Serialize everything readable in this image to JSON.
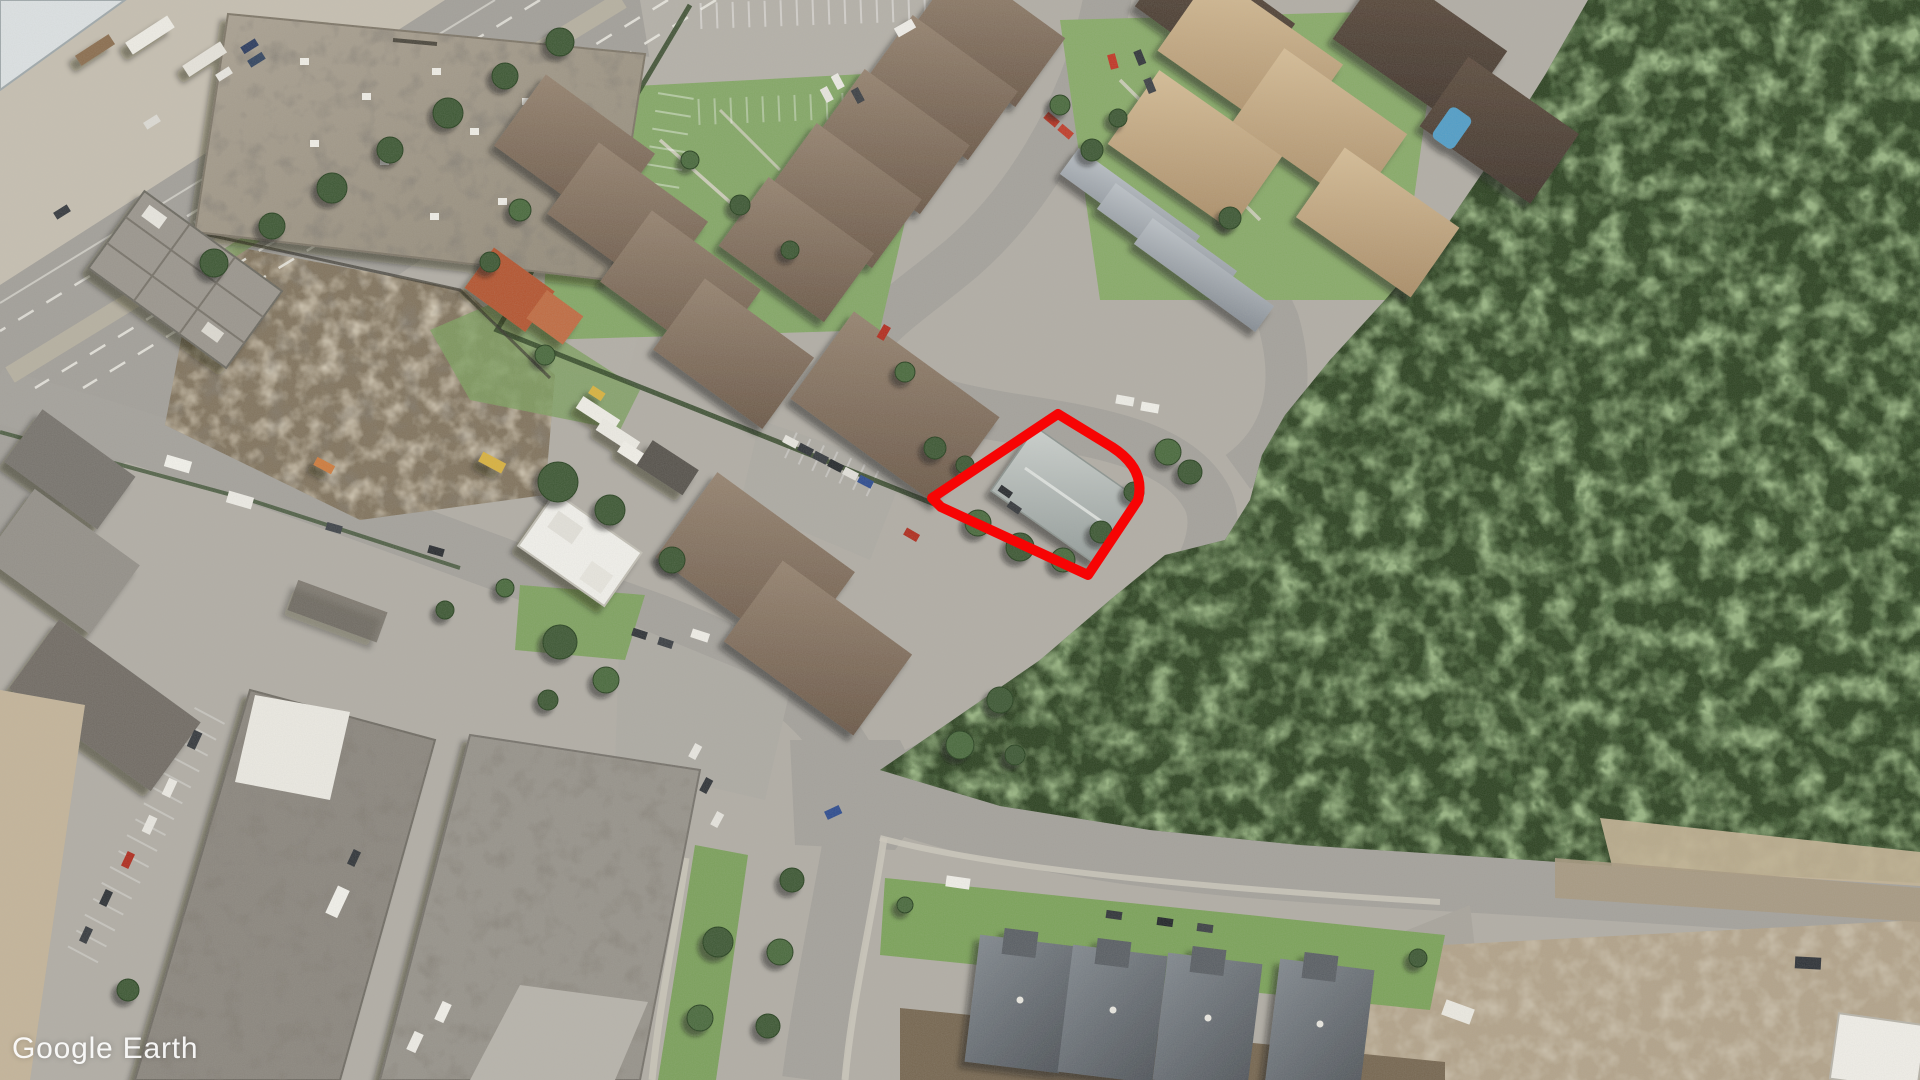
{
  "watermark": {
    "text": "Google Earth"
  },
  "highlight": {
    "name": "property-boundary",
    "color": "#f70404",
    "stroke_width": 10
  },
  "imagery": {
    "type": "satellite-aerial",
    "features": [
      "forest",
      "residential-townhouses",
      "industrial-warehouses",
      "construction-site",
      "arterial-road",
      "local-streets",
      "parking-lots",
      "swimming-pool",
      "highlighted-parcel"
    ],
    "palette": {
      "pavement": "#b1ada5",
      "asphalt": "#a4a19b",
      "forest": "#2a401f",
      "grass": "#7ca35d",
      "dirt": "#7e7059",
      "brown_roof": "#7c685a",
      "tan_roof": "#c0a37e",
      "gray_row_roof": "#9aa1a8",
      "new_gray_roof": "#62686f",
      "commercial_roof": "#a39a89",
      "white_roof": "#f2f1ec",
      "red_outline": "#f70404"
    }
  }
}
